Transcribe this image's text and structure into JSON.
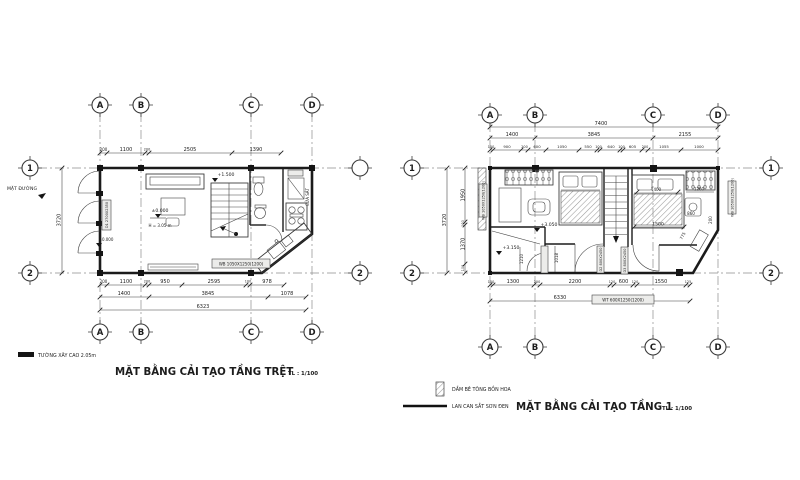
{
  "sheet": {
    "background": "#ffffff",
    "ink": "#1b1b1b"
  },
  "ground_floor": {
    "title": "MẶT BẰNG CẢI TẠO TẦNG TRỆT",
    "scale_label": "TL : 1/100",
    "grid_cols": [
      "A",
      "B",
      "C",
      "D"
    ],
    "grid_rows": [
      "1",
      "2"
    ],
    "grid_rows_right": [
      "",
      "2"
    ],
    "dims_top": [
      "200",
      "1100",
      "200",
      "2505",
      "1390"
    ],
    "dims_bottom_1": [
      "200",
      "1100",
      "200",
      "950",
      "2595",
      "100",
      "978"
    ],
    "dims_bottom_2": [
      "1400",
      "3845",
      "1078"
    ],
    "dim_bottom_total": "6323",
    "dim_left_total": "3720",
    "street_label": "MẶT ĐƯỜNG",
    "level_entry": "±0.000",
    "level_living": "±0.000",
    "level_stair": "+1.500",
    "ceiling_height": "H = 3.05 m",
    "door_tag": "D1 2700X2350",
    "window_tag": "WB 1050X1250(1200)",
    "iron_door_label": "CỬA SẮT",
    "legend_wall": "TƯỜNG XÂY CAO 2.05m"
  },
  "first_floor": {
    "title": "MẶT BẰNG CẢI TẠO TẦNG 1",
    "scale_label": "TL : 1/100",
    "grid_cols": [
      "A",
      "B",
      "C",
      "D"
    ],
    "grid_rows": [
      "1",
      "2"
    ],
    "dim_top_total": "7400",
    "dims_top_axes": [
      "1400",
      "3845",
      "2155"
    ],
    "dims_top_detail": [
      "100",
      "900",
      "200",
      "600",
      "1050",
      "550",
      "100",
      "640",
      "100",
      "605",
      "200",
      "1055",
      "1000"
    ],
    "dims_left": [
      "1950",
      "100",
      "1370",
      "100"
    ],
    "dim_left_total": "3720",
    "dims_bottom": [
      "100",
      "1300",
      "200",
      "2200",
      "120",
      "600",
      "120",
      "1550",
      "125"
    ],
    "dim_bottom_total": "6330",
    "window_tag_left": "WB 1050X1250(1200)",
    "window_tag_right": "WB 1050X1250(1200)",
    "window_tag_bottom": "WT 600X1250(1200)",
    "door_tags": [
      "D4 800X2100",
      "D2 800X2450",
      "D3 800X2450"
    ],
    "level_bedroom": "+3.050",
    "level_bath": "+3.150",
    "dims_inner": {
      "bed2_width": "1400",
      "wardrobe_width": "1260",
      "desk": "860",
      "bed2_length": "1500",
      "diagonal": "775",
      "corner": "200",
      "bath_width": "1210",
      "hall_width": "1018"
    },
    "legend": [
      {
        "label": "DẦM BÊ TÔNG BỒN HOA"
      },
      {
        "label": "LAN CAN SẮT SƠN ĐEN"
      }
    ]
  }
}
